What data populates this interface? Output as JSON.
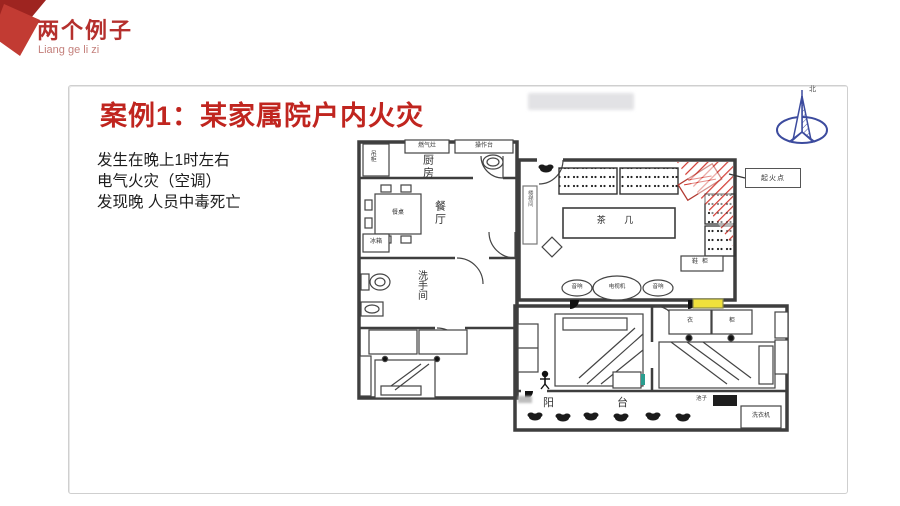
{
  "header": {
    "title": "两个例子",
    "subtitle": "Liang ge li zi"
  },
  "case": {
    "title": "案例1：某家属院户内火灾",
    "body_lines": [
      "发生在晚上1时左右",
      "电气火灾（空调）",
      "发现晚 人员中毒死亡"
    ]
  },
  "floorplan": {
    "rooms": {
      "kitchen": "厨房",
      "dining": "餐厅",
      "bathroom": "洗手间",
      "balcony": "阳 台",
      "stairwell": "楼梯间"
    },
    "furniture": {
      "hanging_cabinet": "吊柜",
      "gas_stove": "燃气灶",
      "counter": "操作台",
      "dining_table": "餐桌",
      "fridge": "冰箱",
      "tea_table": "茶 几",
      "tv": "电视机",
      "speaker": "音响",
      "shoe_cabinet": "鞋柜",
      "wardrobe_door_a": "衣",
      "wardrobe_door_b": "柜",
      "basin": "池子",
      "washing_machine": "洗衣机"
    },
    "annotations": {
      "fire_origin": "起火点",
      "north": "北"
    }
  },
  "colors": {
    "accent_red": "#b5302d",
    "title_red": "#c0251f",
    "fire_hatch_red": "#d0342c",
    "highlight_yellow": "#f0e13c",
    "compass_blue": "#3c4b9e"
  }
}
